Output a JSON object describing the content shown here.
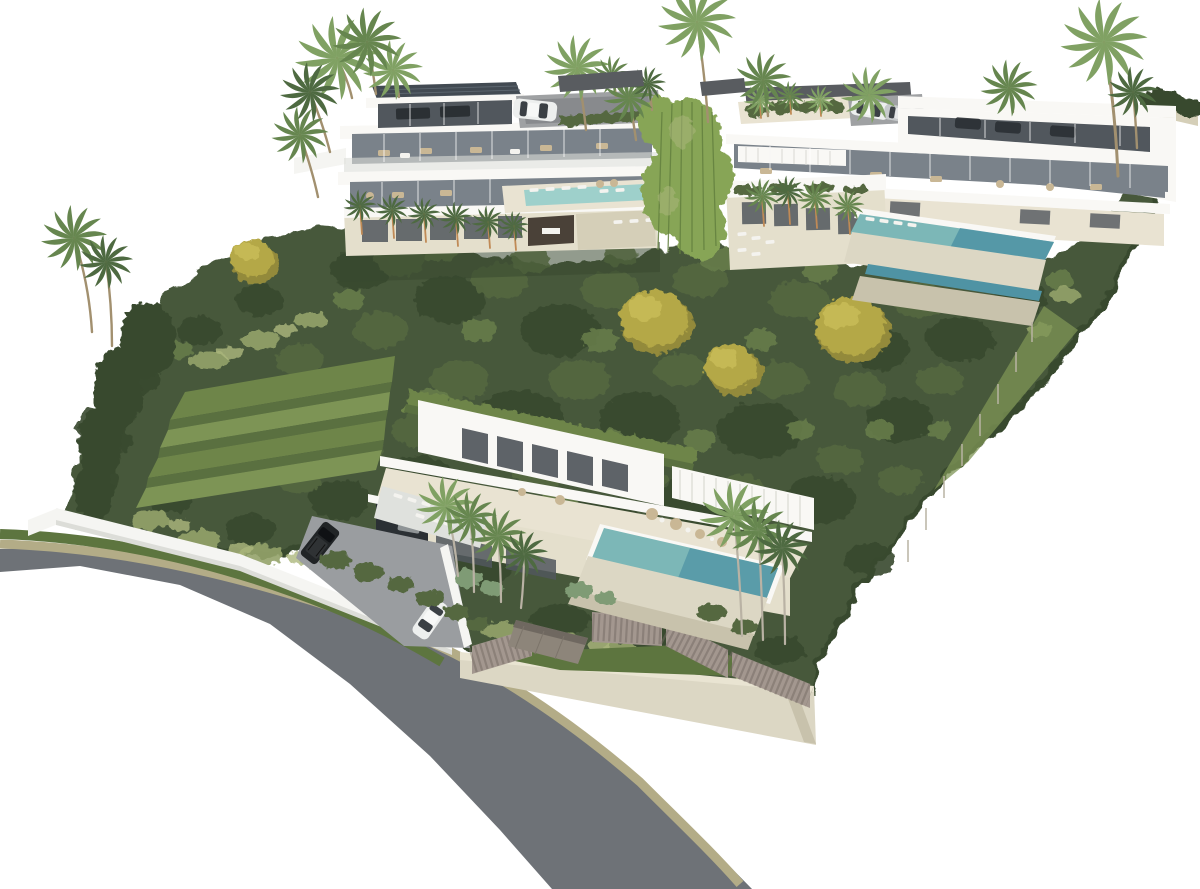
{
  "meta": {
    "description": "Aerial 3D architectural rendering of a hillside luxury development: three modern white flat-roof villas with infinity pools, dense tree canopy, terraced lawn, palm trees, boundary hedges, wooden slat fence, white perimeter wall and a curved asphalt access road on white background",
    "style": "photorealistic CGI, high-angle aerial view",
    "background": "#ffffff"
  },
  "scene": {
    "villas": [
      {
        "id": "villa-west",
        "label": "Four-level villa, solar-panel penthouse roof, rooftop parking with one white car, elevated terrace pool"
      },
      {
        "id": "villa-east",
        "label": "Stepped villa, rooftop parking with two cars, glass garage wing, long diagonal infinity pool with lower water channel"
      },
      {
        "id": "villa-south",
        "label": "Green-roof villa with pergola terrace, infinity pool, palm garden, driveway and garage"
      }
    ],
    "vehicles": [
      {
        "id": "white-suv-roof-west"
      },
      {
        "id": "white-car-roof-east"
      },
      {
        "id": "silver-car-roof-east"
      },
      {
        "id": "black-suv-driveway"
      },
      {
        "id": "white-car-driveway"
      }
    ],
    "landscape": [
      "dense dark-green tree canopy",
      "four yellow flowering trees",
      "stepped grass terraces",
      "bamboo grove between villas",
      "tall palm trees",
      "small orange-trunk terrace palms",
      "white perimeter wall",
      "beige stone retaining wall",
      "wooden slat fence",
      "small neighbouring tiled roof",
      "curved asphalt road with khaki footpath",
      "boundary fence posts"
    ]
  },
  "colors": {
    "bg": "#ffffff",
    "canopy_base": "#46583b",
    "canopy_dark": "#39492f",
    "canopy_mid": "#546741",
    "canopy_light": "#687e4b",
    "bush_pale": "#94a36b",
    "bush_paler": "#adb87e",
    "tree_yellow": "#b4a847",
    "tree_yellow_hi": "#c9bc58",
    "tree_yellow_sh": "#938a3a",
    "bamboo": "#87a557",
    "bamboo_stem": "#63803f",
    "lawn_top": "#6e8549",
    "lawn_front": "#5a7040",
    "lawn_hi": "#7d9455",
    "grass_strip": "#5d753f",
    "road": "#6e7277",
    "road_drive": "#9a9da0",
    "path_khaki": "#b3ac87",
    "wall_white": "#f5f5f2",
    "wall_shadow": "#dcddd8",
    "stone": "#dcd7c4",
    "stone_dark": "#c8c2ac",
    "stone_lip": "#e9e4d2",
    "fence_wood": "#a3978f",
    "fence_dark": "#756b64",
    "roof_small": "#8d857a",
    "roof_small_dark": "#6f6860",
    "bld_white": "#f9f8f5",
    "bld_shadow": "#e6e6e0",
    "facade_beige": "#e4dfcc",
    "facade_dark": "#d5cfb8",
    "glass": "#7a828a",
    "glass_dark": "#51575d",
    "interior_dark": "#2b3034",
    "door_brown": "#4a4138",
    "roof_solar": "#424a52",
    "roof_solar_line": "#5c666f",
    "roof_deck": "#9fa1a3",
    "roof_paver": "#888a8d",
    "wall_gray": "#595c60",
    "pool_light": "#9ed0cb",
    "pool_mid": "#7cb7b7",
    "pool_deep": "#4f93a4",
    "deck_beige": "#e9e3d2",
    "deck_gray": "#dfe1dd",
    "furn_tan": "#c9b795",
    "furn_gray": "#8f9496",
    "furn_white": "#f4f3ef",
    "car_white": "#edefee",
    "car_silver": "#c7cacc",
    "car_glass": "#3b4045",
    "suv_black": "#212426",
    "suv_glass": "#0f1114",
    "suv_roof": "#2f3234",
    "trunk": "#a2906f",
    "trunk_pale": "#b9b2a4",
    "trunk_orange": "#c08a56",
    "palm_dark": "#4e6a41",
    "palm_mid": "#66864f",
    "palm_light": "#80a163",
    "post": "#b9b3a3",
    "agave": "#7f9b74",
    "white": "#ffffff"
  }
}
